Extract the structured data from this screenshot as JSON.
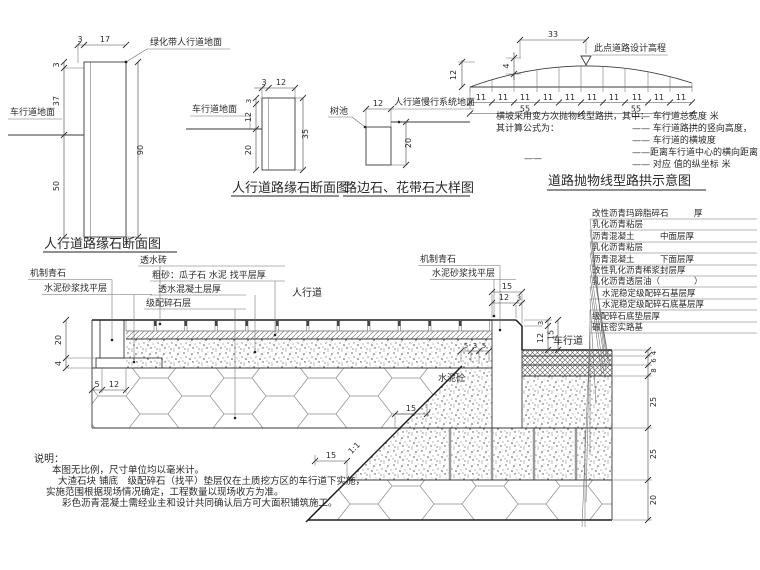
{
  "figA": {
    "title": "人行道路缘石断面图",
    "ground_top": "绿化带人行道地面",
    "ground_left": "车行道地面",
    "dims": {
      "t1": "3",
      "t2": "17",
      "l1": "3",
      "l2": "37",
      "l3": "50",
      "r": "90"
    }
  },
  "figB": {
    "title": "人行道路缘石断面图",
    "ground_left": "车行道地面",
    "dims": {
      "t1": "3",
      "t2": "12",
      "l1": "3",
      "l2": "12",
      "l3": "20",
      "r": "35"
    }
  },
  "figC": {
    "title": "路边石、花带石大样图",
    "tree_pit": "树池",
    "ground_right": "人行道慢行系统地面",
    "dims": {
      "t": "12",
      "r": "20"
    }
  },
  "figD": {
    "title": "道路抛物线型路拱示意图",
    "apex_label": "此点道路设计高程",
    "dims": {
      "w33": "33",
      "h4": "4",
      "h12": "12",
      "seg": "11",
      "half": "55"
    },
    "text_left1": "横坡采用变方次抛物线型路拱，其中：",
    "text_left2": "其计算公式为：",
    "formula_dash": "——",
    "legend": [
      "—— 车行道总宽度 米",
      "—— 车行道路拱的竖向高度，",
      "—— 车行道的横坡度",
      "——距离车行道中心的横向距离",
      "—— 对应 值的纵坐标 米"
    ]
  },
  "main": {
    "labels_left": [
      "机制青石",
      "水泥砂浆找平层"
    ],
    "labels_center": [
      "透水砖",
      "粗砂：瓜子石 水泥 找平层厚",
      "透水混凝土层厚",
      "级配碎石层"
    ],
    "sidewalk": "人行道",
    "labels_curb": [
      "机制青石",
      "水泥砂浆找平层"
    ],
    "roadway": "车行道",
    "concrete": "水泥砼",
    "slope": "1:1",
    "layers": [
      "改性沥青玛蹄脂碎石　　　厚",
      "乳化沥青粘层",
      "沥青混凝土　　　中面层厚",
      "乳化沥青粘层",
      "沥青混凝土　　　下面层厚",
      "改性乳化沥青稀浆封层厚",
      "乳化沥青透层油（　　　　）",
      "水泥稳定级配碎石基层厚",
      "水泥稳定级配碎石底基层厚",
      "级配碎石底垫层厚",
      "碾压密实路基"
    ],
    "dims": {
      "h20": "20",
      "h4": "4",
      "w5": "5",
      "w12": "12",
      "c15": "15",
      "c12": "12",
      "c3": "3",
      "v3": "3",
      "v12": "12",
      "v15": "15",
      "s5a": "5",
      "s3": "3",
      "s5b": "5",
      "step15": "15",
      "L1": "4",
      "L2": "6",
      "L3": "8",
      "L4": "25",
      "L5": "25",
      "L6": "20"
    }
  },
  "notes": {
    "heading": "说明：",
    "lines": [
      "本图无比例，尺寸单位均以毫米计。",
      "大渣石块 铺底　级配碎石（找平）垫层仅在土质挖方区的车行道下实施，",
      "实施范围根据现场情况确定，工程数量以现场收方为准。",
      "彩色沥青混凝土需经业主和设计共同确认后方可大面积铺筑施工。"
    ]
  }
}
